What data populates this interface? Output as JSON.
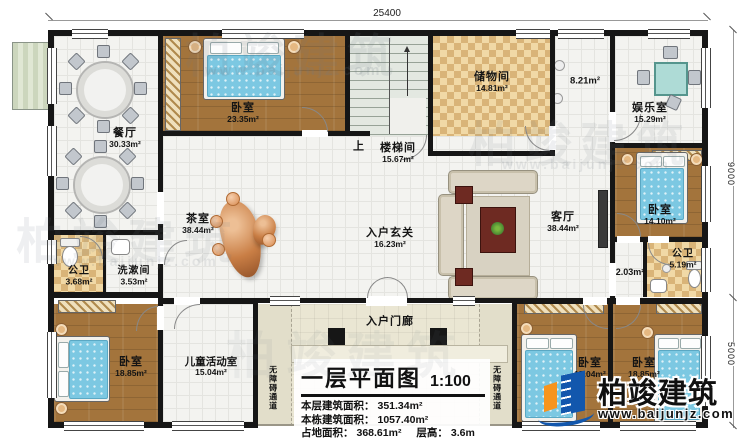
{
  "plan_title": {
    "text": "一层平面图",
    "scale": "1:100"
  },
  "stats": {
    "line1_label": "本层建筑面积：",
    "line1_value": "351.34m²",
    "line2_label": "本栋建筑面积：",
    "line2_value": "1057.40m²",
    "line3_label": "占地面积：",
    "line3_value": "368.61m²",
    "line3b_label": "层高：",
    "line3b_value": "3.6m"
  },
  "dimensions": {
    "top": "25400",
    "right_upper": "9000",
    "right_lower": "5000"
  },
  "rooms": {
    "dining": {
      "label": "餐厅",
      "area": "30.33m²"
    },
    "bedroom_top": {
      "label": "卧室",
      "area": "23.35m²"
    },
    "stairwell": {
      "label": "楼梯间",
      "area": "15.67m²",
      "up": "上"
    },
    "storage": {
      "label": "储物间",
      "area": "14.81m²"
    },
    "hall_upper": {
      "area": "8.21m²"
    },
    "entertainment": {
      "label": "娱乐室",
      "area": "15.29m²"
    },
    "bedroom_right": {
      "label": "卧室",
      "area": "14.10m²"
    },
    "tearoom": {
      "label": "茶室",
      "area": "38.44m²"
    },
    "foyer": {
      "label": "入户玄关",
      "area": "16.23m²"
    },
    "living": {
      "label": "客厅",
      "area": "38.44m²"
    },
    "bath_left": {
      "label": "公卫",
      "area": "3.68m²"
    },
    "washroom": {
      "label": "洗漱间",
      "area": "3.53m²"
    },
    "bedroom_bl": {
      "label": "卧室",
      "area": "18.85m²"
    },
    "kids": {
      "label": "儿童活动室",
      "area": "15.04m²"
    },
    "porch": {
      "label": "入户门廊"
    },
    "ramp": {
      "label": "无障碍通道"
    },
    "bedroom_br1": {
      "label": "卧室",
      "area": "15.04m²"
    },
    "bedroom_br2": {
      "label": "卧室",
      "area": "18.85m²"
    },
    "bath_right": {
      "label": "公卫",
      "area": "5.19m²"
    },
    "hall_lower": {
      "area": "2.03m²"
    }
  },
  "logo": {
    "brand": "柏竣建筑",
    "site": "www.baijunjz.com"
  },
  "watermark": {
    "brand": "柏竣建筑",
    "site": "www.baijunjz.com"
  },
  "colors": {
    "wall": "#161616",
    "wood_floor": "#a3743c",
    "checker_floor": "#e8c88f",
    "bed_blue": "#7cc8e2",
    "logo_blue": "#1257ad",
    "logo_orange": "#f7941d"
  }
}
